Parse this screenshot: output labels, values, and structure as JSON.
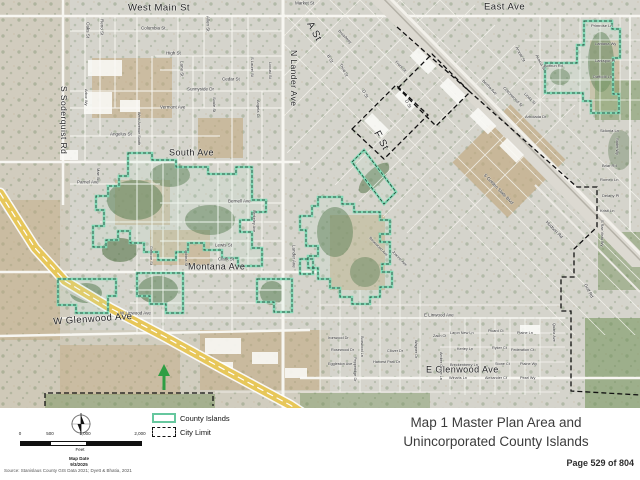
{
  "page": {
    "title_line1": "Map 1 Master Plan Area and",
    "title_line2": "Unincorporated County Islands",
    "page_number": "Page 529 of 804",
    "source": "Source: Stanislaus County GIS Data 2021; Dyett & Bhatia, 2021"
  },
  "legend": {
    "items": [
      {
        "label": "County Islands",
        "swatch_border": "#66c79e",
        "swatch_style": "solid"
      },
      {
        "label": "City Limit",
        "swatch_border": "#111111",
        "swatch_style": "dashed"
      }
    ]
  },
  "scale_bar": {
    "ticks": [
      "0",
      "500",
      "1,000",
      "2,000"
    ],
    "unit": "Feet",
    "map_date_label": "Map Date",
    "map_date": "9/3/2025"
  },
  "icons": {
    "north_arrow": "compass-north-arrow",
    "green_marker": "green-up-arrow"
  },
  "map": {
    "colors": {
      "county_island_outline": "#7ed9b4",
      "city_limit": "#111111",
      "freeway": "#e7c75a",
      "aerial_base": "#d5d4cc"
    },
    "street_labels": [
      {
        "text": "West Main St",
        "x": 128,
        "y": 3,
        "rot": 0,
        "size": 9.5
      },
      {
        "text": "East Ave",
        "x": 484,
        "y": 2,
        "rot": 0,
        "size": 9.5
      },
      {
        "text": "S Soderquist Rd",
        "x": 68,
        "y": 86,
        "rot": 90,
        "size": 8.5
      },
      {
        "text": "N Lander Ave",
        "x": 298,
        "y": 50,
        "rot": 90,
        "size": 8.5
      },
      {
        "text": "South Ave",
        "x": 169,
        "y": 148,
        "rot": 0,
        "size": 9
      },
      {
        "text": "Montana Ave",
        "x": 188,
        "y": 262,
        "rot": 0,
        "size": 9
      },
      {
        "text": "W Glenwood Ave",
        "x": 53,
        "y": 317,
        "rot": -4,
        "size": 9.5
      },
      {
        "text": "E Glenwood Ave",
        "x": 426,
        "y": 365,
        "rot": 0,
        "size": 9
      },
      {
        "text": "A St",
        "x": 314,
        "y": 20,
        "rot": 62,
        "size": 10
      },
      {
        "text": "F St",
        "x": 381,
        "y": 129,
        "rot": 62,
        "size": 10
      },
      {
        "text": "Market St",
        "x": 295,
        "y": 1,
        "rot": 0,
        "size": 4.5
      },
      {
        "text": "Columbia St",
        "x": 141,
        "y": 26,
        "rot": 0,
        "size": 4.5
      },
      {
        "text": "Oaks St",
        "x": 90,
        "y": 22,
        "rot": 90,
        "size": 4.5
      },
      {
        "text": "Reno St",
        "x": 104,
        "y": 19,
        "rot": 90,
        "size": 4.5
      },
      {
        "text": "Allen St",
        "x": 210,
        "y": 16,
        "rot": 90,
        "size": 4.5
      },
      {
        "text": "High St",
        "x": 166,
        "y": 51,
        "rot": 0,
        "size": 4.5
      },
      {
        "text": "Lane St",
        "x": 184,
        "y": 61,
        "rot": 90,
        "size": 4.5
      },
      {
        "text": "Cedar St",
        "x": 222,
        "y": 77,
        "rot": 0,
        "size": 4.5
      },
      {
        "text": "S Laurel St",
        "x": 254,
        "y": 57,
        "rot": 90,
        "size": 4
      },
      {
        "text": "Locust St",
        "x": 272,
        "y": 62,
        "rot": 90,
        "size": 4
      },
      {
        "text": "Sunnyside Dr",
        "x": 187,
        "y": 87,
        "rot": 0,
        "size": 4.5
      },
      {
        "text": "Vermont Ave",
        "x": 160,
        "y": 105,
        "rot": 0,
        "size": 4.5
      },
      {
        "text": "Soule St",
        "x": 216,
        "y": 97,
        "rot": 90,
        "size": 4
      },
      {
        "text": "Angelus St",
        "x": 110,
        "y": 132,
        "rot": 0,
        "size": 4.5
      },
      {
        "text": "West Avenue South",
        "x": 141,
        "y": 112,
        "rot": 90,
        "size": 3.8
      },
      {
        "text": "Arbor Wy",
        "x": 88,
        "y": 89,
        "rot": 90,
        "size": 4
      },
      {
        "text": "Angela Ct",
        "x": 260,
        "y": 100,
        "rot": 90,
        "size": 4
      },
      {
        "text": "Parnel Ave",
        "x": 77,
        "y": 180,
        "rot": 0,
        "size": 4.5
      },
      {
        "text": "Mae St",
        "x": 100,
        "y": 168,
        "rot": 90,
        "size": 4
      },
      {
        "text": "Bernell Ave",
        "x": 228,
        "y": 199,
        "rot": 0,
        "size": 4.5
      },
      {
        "text": "Berkeley Ave",
        "x": 256,
        "y": 210,
        "rot": 90,
        "size": 3.8
      },
      {
        "text": "Lewis St",
        "x": 215,
        "y": 243,
        "rot": 0,
        "size": 4.5
      },
      {
        "text": "Clark St",
        "x": 218,
        "y": 257,
        "rot": 0,
        "size": 4.5
      },
      {
        "text": "Lobina St",
        "x": 188,
        "y": 250,
        "rot": 90,
        "size": 3.8
      },
      {
        "text": "Glencoe St",
        "x": 153,
        "y": 246,
        "rot": 90,
        "size": 3.8
      },
      {
        "text": "Lander Ave",
        "x": 296,
        "y": 245,
        "rot": 90,
        "size": 4.5
      },
      {
        "text": "W Linwood Ave",
        "x": 120,
        "y": 311,
        "rot": 0,
        "size": 4.5
      },
      {
        "text": "E Linwood Ave",
        "x": 424,
        "y": 313,
        "rot": 0,
        "size": 4.5
      },
      {
        "text": "S Golden State Blvd",
        "x": 486,
        "y": 173,
        "rot": 46,
        "size": 4.5
      },
      {
        "text": "Hudson Rd",
        "x": 548,
        "y": 220,
        "rot": 46,
        "size": 4.5
      },
      {
        "text": "Front St",
        "x": 397,
        "y": 60,
        "rot": 46,
        "size": 4
      },
      {
        "text": "Broadway",
        "x": 340,
        "y": 29,
        "rot": 46,
        "size": 4
      },
      {
        "text": "B St",
        "x": 330,
        "y": 54,
        "rot": 62,
        "size": 4.5
      },
      {
        "text": "Third St",
        "x": 342,
        "y": 63,
        "rot": 62,
        "size": 4
      },
      {
        "text": "D St",
        "x": 365,
        "y": 89,
        "rot": 62,
        "size": 4.5
      },
      {
        "text": "D St",
        "x": 408,
        "y": 99,
        "rot": 62,
        "size": 4.5
      },
      {
        "text": "Arnold St",
        "x": 518,
        "y": 46,
        "rot": 62,
        "size": 4
      },
      {
        "text": "Acacia St",
        "x": 538,
        "y": 54,
        "rot": 62,
        "size": 4
      },
      {
        "text": "Bertha Ave",
        "x": 484,
        "y": 79,
        "rot": 46,
        "size": 4
      },
      {
        "text": "Cottonwood St",
        "x": 505,
        "y": 86,
        "rot": 46,
        "size": 4
      },
      {
        "text": "Linda St",
        "x": 526,
        "y": 92,
        "rot": 46,
        "size": 4
      },
      {
        "text": "Primrose Ln",
        "x": 591,
        "y": 24,
        "rot": 0,
        "size": 4
      },
      {
        "text": "Lantana Wy",
        "x": 595,
        "y": 42,
        "rot": 0,
        "size": 4
      },
      {
        "text": "Larkspur Pl",
        "x": 595,
        "y": 59,
        "rot": 0,
        "size": 4
      },
      {
        "text": "Daffodil Ln",
        "x": 593,
        "y": 75,
        "rot": 0,
        "size": 4
      },
      {
        "text": "Bothun Rd",
        "x": 544,
        "y": 64,
        "rot": 0,
        "size": 4
      },
      {
        "text": "Arbolada Dr",
        "x": 525,
        "y": 115,
        "rot": 0,
        "size": 4
      },
      {
        "text": "Sidonia Ln",
        "x": 600,
        "y": 129,
        "rot": 0,
        "size": 4
      },
      {
        "text": "Rader Wy",
        "x": 619,
        "y": 138,
        "rot": 90,
        "size": 3.8
      },
      {
        "text": "Briar Rd",
        "x": 602,
        "y": 164,
        "rot": 0,
        "size": 4
      },
      {
        "text": "Romeo Ln",
        "x": 600,
        "y": 178,
        "rot": 0,
        "size": 4
      },
      {
        "text": "Delany Pl",
        "x": 602,
        "y": 194,
        "rot": 0,
        "size": 4
      },
      {
        "text": "Kristi Ln",
        "x": 600,
        "y": 209,
        "rot": 0,
        "size": 4
      },
      {
        "text": "S Rae Vista Wy",
        "x": 604,
        "y": 220,
        "rot": 90,
        "size": 3.8
      },
      {
        "text": "Golf Rd",
        "x": 587,
        "y": 283,
        "rot": 62,
        "size": 4.5
      },
      {
        "text": "Quartz Ave",
        "x": 556,
        "y": 323,
        "rot": 90,
        "size": 3.8
      },
      {
        "text": "Rosewood Ave",
        "x": 371,
        "y": 236,
        "rot": 46,
        "size": 3.8
      },
      {
        "text": "Joanne Ave",
        "x": 394,
        "y": 250,
        "rot": 46,
        "size": 3.8
      },
      {
        "text": "Zach Ct",
        "x": 433,
        "y": 334,
        "rot": 0,
        "size": 3.8
      },
      {
        "text": "Laron New Ln",
        "x": 450,
        "y": 331,
        "rot": 0,
        "size": 3.8
      },
      {
        "text": "Picard Ct",
        "x": 488,
        "y": 329,
        "rot": 0,
        "size": 3.8
      },
      {
        "text": "Plaine Ln",
        "x": 517,
        "y": 331,
        "rot": 0,
        "size": 3.8
      },
      {
        "text": "Kerley Ln",
        "x": 457,
        "y": 347,
        "rot": 0,
        "size": 3.8
      },
      {
        "text": "Ryker Ct",
        "x": 492,
        "y": 346,
        "rot": 0,
        "size": 3.8
      },
      {
        "text": "Federation Ct",
        "x": 511,
        "y": 348,
        "rot": 0,
        "size": 3.8
      },
      {
        "text": "Breckenberry Ln",
        "x": 450,
        "y": 363,
        "rot": 0,
        "size": 3.8
      },
      {
        "text": "Stone Ct",
        "x": 495,
        "y": 362,
        "rot": 0,
        "size": 3.8
      },
      {
        "text": "Plaine Wy",
        "x": 520,
        "y": 362,
        "rot": 0,
        "size": 3.8
      },
      {
        "text": "Winans Ln",
        "x": 449,
        "y": 376,
        "rot": 0,
        "size": 3.8
      },
      {
        "text": "Alexander Ct",
        "x": 485,
        "y": 376,
        "rot": 0,
        "size": 3.8
      },
      {
        "text": "Pearl Wy",
        "x": 520,
        "y": 376,
        "rot": 0,
        "size": 3.8
      },
      {
        "text": "Clover Dr",
        "x": 387,
        "y": 349,
        "rot": 0,
        "size": 3.8
      },
      {
        "text": "Wagner Dr",
        "x": 418,
        "y": 340,
        "rot": 90,
        "size": 3.8
      },
      {
        "text": "Harvest Park Dr",
        "x": 373,
        "y": 360,
        "rot": 0,
        "size": 3.8
      },
      {
        "text": "Eggleston Ave",
        "x": 328,
        "y": 362,
        "rot": 0,
        "size": 3.8
      },
      {
        "text": "Ironwood Dr",
        "x": 328,
        "y": 336,
        "rot": 0,
        "size": 3.8
      },
      {
        "text": "Rosewood Dr",
        "x": 331,
        "y": 348,
        "rot": 0,
        "size": 3.8
      },
      {
        "text": "Amber Grove Ln",
        "x": 443,
        "y": 352,
        "rot": 90,
        "size": 3.8
      },
      {
        "text": "Boxwood Ln",
        "x": 364,
        "y": 336,
        "rot": 90,
        "size": 3.8
      },
      {
        "text": "Pepperidge Dr",
        "x": 357,
        "y": 357,
        "rot": 90,
        "size": 3.8
      }
    ]
  }
}
